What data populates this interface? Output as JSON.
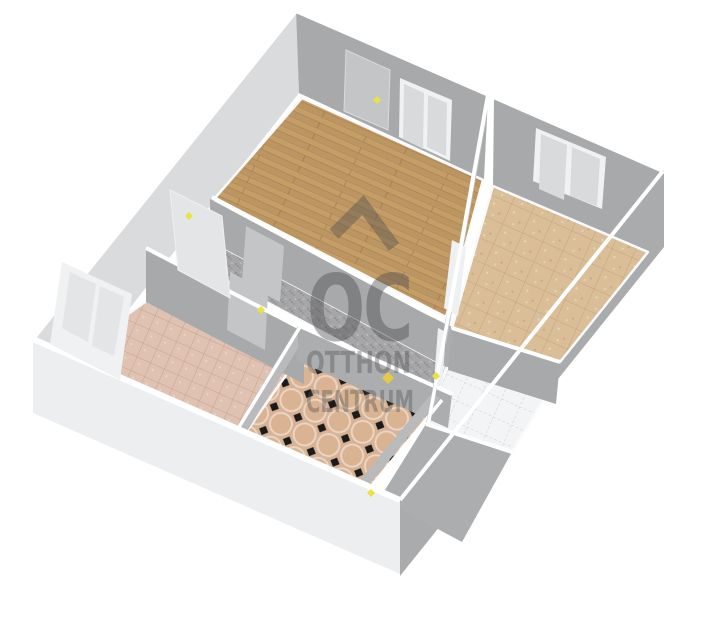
{
  "watermark": {
    "oc": "OC",
    "line1": "OTTHON",
    "line2": "CENTRUM"
  },
  "floors": {
    "top_room": "parquet-wood",
    "right_room": "tan-ceramic-tile",
    "left_room": "rose-ceramic-tile",
    "kitchen": "octagon-tile-black-dots",
    "bathroom": "white-tile",
    "hallway": "gray-carpet"
  },
  "colors": {
    "background": "#FFFFFF",
    "wallGray": "#A7A9AB",
    "wallGrayMid": "#ABADAF",
    "wallGrayLight": "#B8BABC",
    "wallFaceLight": "#DADBDD",
    "wallExterior": "#EDEEF0",
    "wallTop": "#FFFFFF",
    "eastWall": "#A9ABAD",
    "partition": "#BFC1C3",
    "woodFloor": "#C59E67",
    "tanTile": "#DABE97",
    "pinkTile": "#DFC2B1",
    "octagonTile": "#D8B294",
    "octagonDot": "#1B1B1B",
    "whiteTile": "#F3F4F6",
    "hallCarpet": "#A6A6A8",
    "doorLeaf": "#C3C5C7",
    "doorLeafLight": "#EFF0F2",
    "doorFaint": "#E4E5E7",
    "windowPane": "#D8DADC",
    "windowFrame": "#F0F1F3",
    "handleYellow": "#E9E23F",
    "logoDiamond": "#EFCB3B",
    "watermark": "#4A4B4D",
    "baseboard": "#FAFAFB"
  }
}
